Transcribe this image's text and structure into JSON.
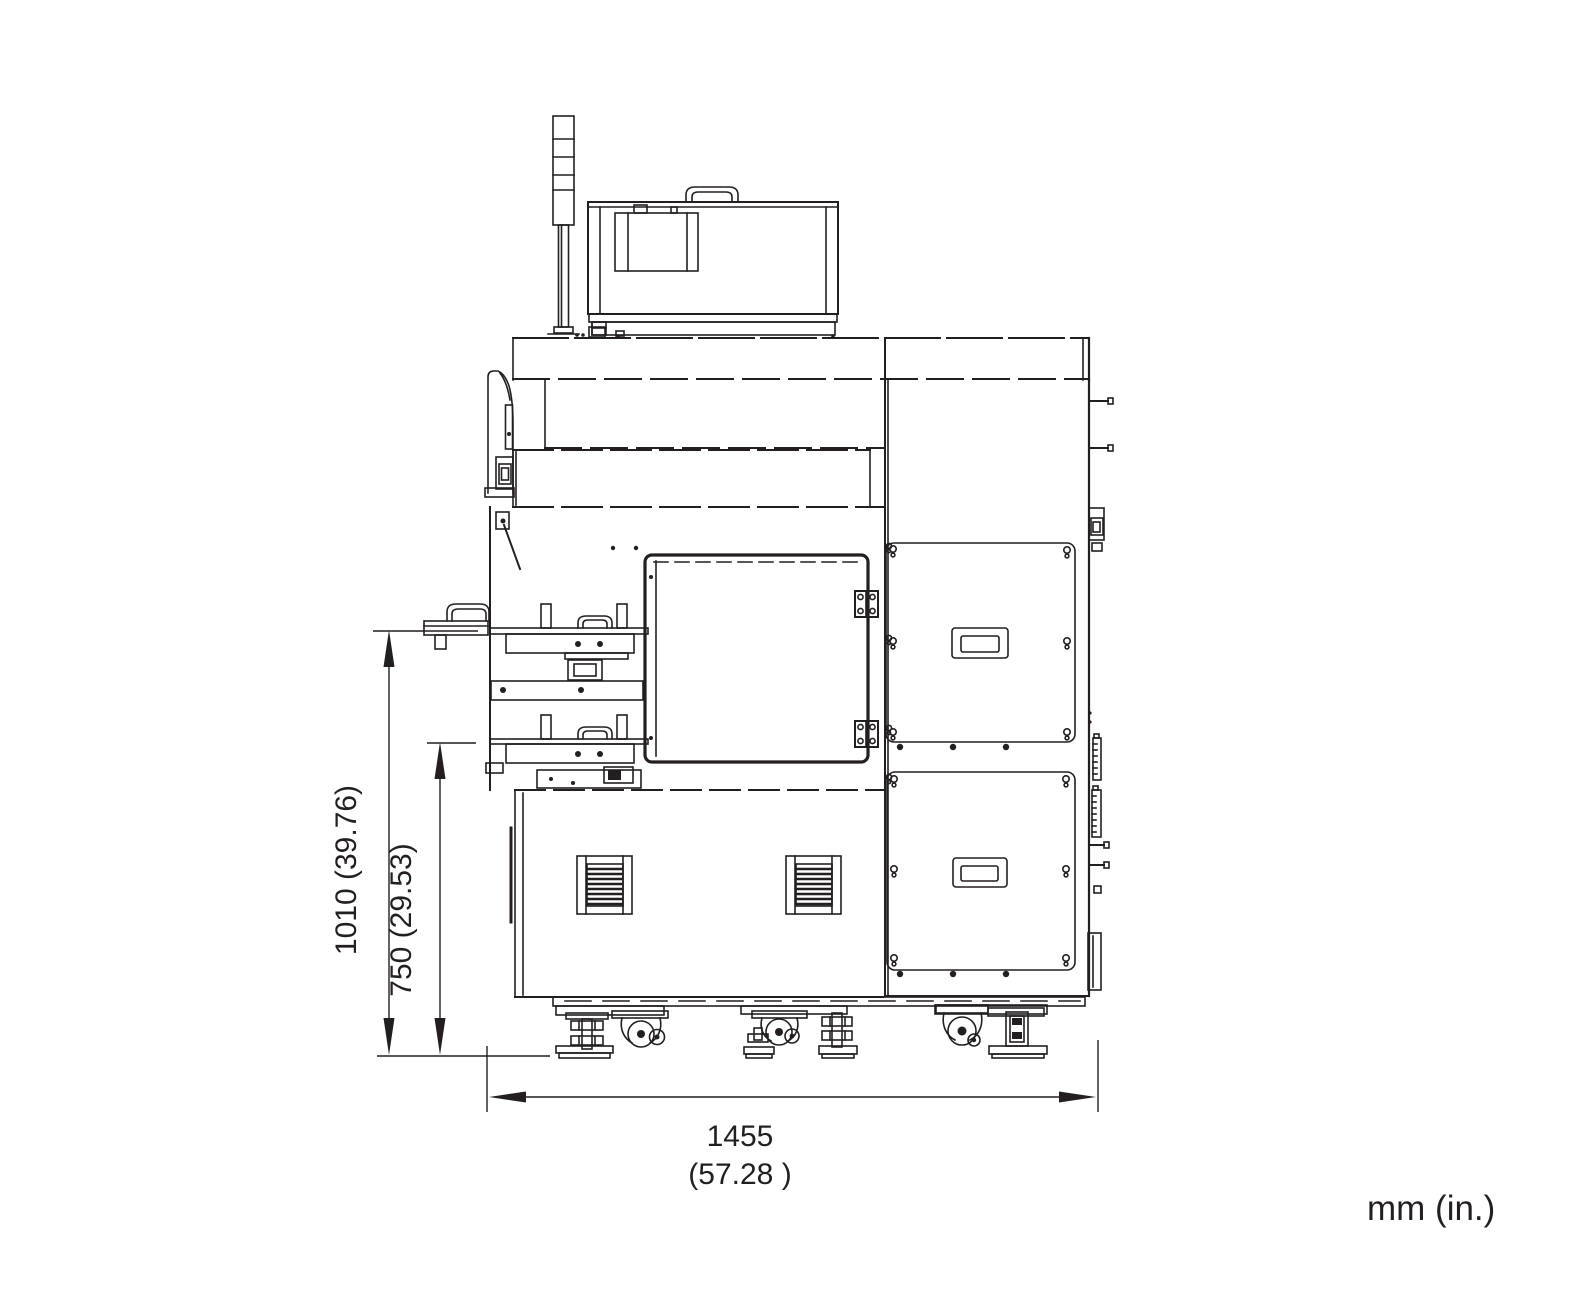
{
  "drawing": {
    "units_note": "mm (in.)",
    "dimensions": {
      "overall_height": {
        "label": "1010 (39.76)",
        "mm": 1010,
        "in": 39.76
      },
      "table_height": {
        "label": "750 (29.53)",
        "mm": 750,
        "in": 29.53
      },
      "overall_width": {
        "label_mm": "1455",
        "label_in": "(57.28  )",
        "mm": 1455,
        "in": 57.28
      }
    },
    "colors": {
      "line": "#231f20",
      "background": "#ffffff"
    }
  }
}
